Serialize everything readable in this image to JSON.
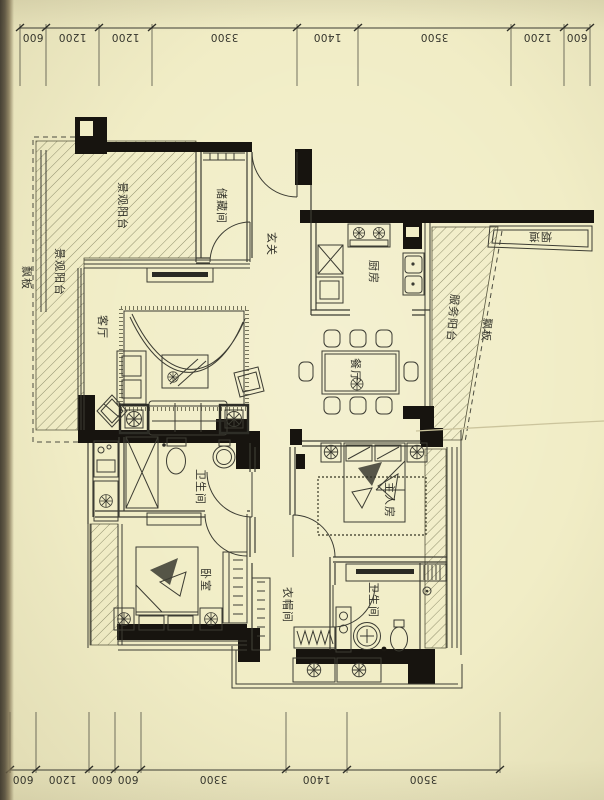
{
  "dimensions": {
    "top": [
      "600",
      "1200",
      "1200",
      "3300",
      "1400",
      "3500",
      "1200",
      "600"
    ],
    "bottom": [
      "600",
      "1200",
      "600",
      "600",
      "3300",
      "1400",
      "3500"
    ]
  },
  "rooms": {
    "viewing_balcony_top": "景观阳台",
    "viewing_balcony_left": "景观阳台",
    "eave_board_left": "飘板",
    "storage_room": "储藏间",
    "entry_hall": "玄关",
    "kitchen": "厨房",
    "service_balcony": "服务阳台",
    "eave_board_right": "飘板",
    "flue": "烟道",
    "dining_room": "餐厅",
    "living_room": "客厅",
    "bathroom_1": "卫生间",
    "master_bedroom": "主人房",
    "bedroom": "卧室",
    "cloakroom": "衣帽间",
    "bathroom_2": "卫生间"
  },
  "colors": {
    "paper": "#f1edc6",
    "ink": "#3b3b32",
    "bearing_wall": "#17140f",
    "hatch": "#91906e"
  }
}
